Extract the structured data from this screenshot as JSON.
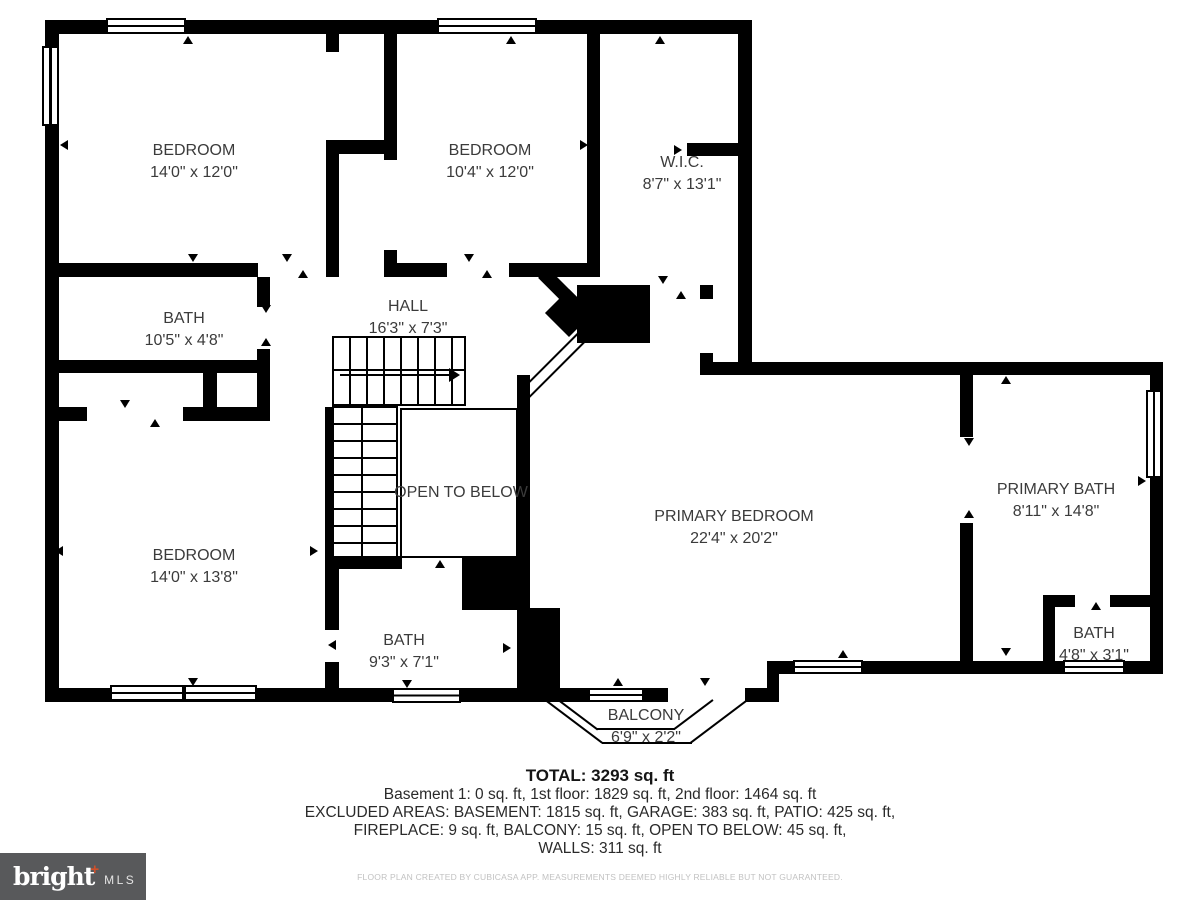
{
  "rooms": [
    {
      "id": "bedroom-top-left",
      "name": "BEDROOM",
      "dims": "14'0\" x 12'0\""
    },
    {
      "id": "bedroom-top-middle",
      "name": "BEDROOM",
      "dims": "10'4\" x 12'0\""
    },
    {
      "id": "walk-in-closet",
      "name": "W.I.C.",
      "dims": "8'7\" x 13'1\""
    },
    {
      "id": "bath-left",
      "name": "BATH",
      "dims": "10'5\" x 4'8\""
    },
    {
      "id": "hall",
      "name": "HALL",
      "dims": "16'3\" x 7'3\""
    },
    {
      "id": "bedroom-bottom-left",
      "name": "BEDROOM",
      "dims": "14'0\" x 13'8\""
    },
    {
      "id": "open-to-below",
      "name": "OPEN TO BELOW",
      "dims": ""
    },
    {
      "id": "bath-center",
      "name": "BATH",
      "dims": "9'3\" x 7'1\""
    },
    {
      "id": "primary-bedroom",
      "name": "PRIMARY BEDROOM",
      "dims": "22'4\" x 20'2\""
    },
    {
      "id": "primary-bath",
      "name": "PRIMARY BATH",
      "dims": "8'11\" x 14'8\""
    },
    {
      "id": "bath-bottom-right",
      "name": "BATH",
      "dims": "4'8\" x 3'1\""
    },
    {
      "id": "balcony",
      "name": "BALCONY",
      "dims": "6'9\" x 2'2\""
    }
  ],
  "summary": {
    "total_label": "TOTAL: 3293 sq. ft",
    "line1": "Basement 1: 0 sq. ft, 1st floor: 1829 sq. ft, 2nd floor: 1464 sq. ft",
    "line2": "EXCLUDED AREAS: BASEMENT: 1815 sq. ft, GARAGE: 383 sq. ft, PATIO: 425 sq. ft,",
    "line3": "FIREPLACE: 9 sq. ft, BALCONY: 15 sq. ft, OPEN TO BELOW: 45 sq. ft,",
    "line4": "WALLS: 311 sq. ft"
  },
  "disclaimer": "FLOOR PLAN CREATED BY CUBICASA APP. MEASUREMENTS DEEMED HIGHLY RELIABLE BUT NOT GUARANTEED.",
  "logo": {
    "brand": "bright",
    "plus": "+",
    "suffix": "MLS"
  },
  "colors": {
    "wall": "#000000",
    "label_text": "#3b3b3b",
    "summary_text": "#1f1f1f",
    "disclaimer_text": "#c2c2c2",
    "logo_background": "#58595b",
    "logo_text": "#ffffff",
    "logo_accent": "#d0502a"
  }
}
